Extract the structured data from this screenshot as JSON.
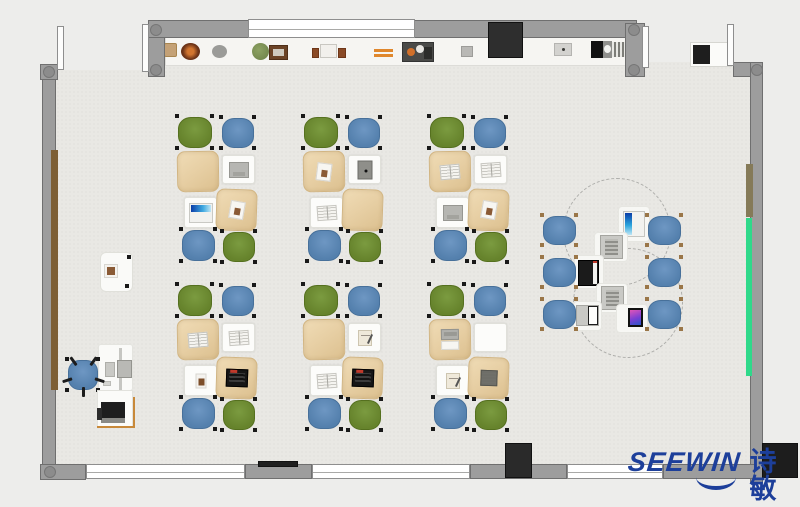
{
  "brand": {
    "name": "SEEWIN",
    "cjk": "诗敏",
    "color": "#1d3f9a"
  },
  "palette": {
    "outside": "#ededeb",
    "floor": "#e9e8e4",
    "wall": "#9d9d9d",
    "wall_border": "#6f6f6f",
    "window": "#ffffff",
    "shelf": "#f6f5f2",
    "desk_white": "#fcfcfa",
    "desk_beige": "#e7cfa4",
    "chair_green": "#66832c",
    "chair_blue": "#5480ad",
    "green_board": "#2fd98a",
    "wood_panel": "#7d5f36",
    "dark_block": "#2e2e2e"
  },
  "floor": {
    "x": 56,
    "y": 38,
    "w": 694,
    "h": 426
  },
  "outside_patches": [
    {
      "name": "outside-patch-top-left",
      "x": 56,
      "y": 38,
      "w": 92,
      "h": 32
    },
    {
      "name": "outside-patch-top-right",
      "x": 645,
      "y": 38,
      "w": 105,
      "h": 24
    }
  ],
  "walls": [
    {
      "name": "wall-left",
      "x": 42,
      "y": 64,
      "w": 14,
      "h": 416
    },
    {
      "name": "wall-corner-top-left",
      "x": 40,
      "y": 64,
      "w": 18,
      "h": 16
    },
    {
      "name": "wall-post-top-left",
      "x": 148,
      "y": 23,
      "w": 17,
      "h": 54
    },
    {
      "name": "wall-top",
      "x": 148,
      "y": 20,
      "w": 489,
      "h": 18
    },
    {
      "name": "wall-post-top-right",
      "x": 625,
      "y": 23,
      "w": 20,
      "h": 54
    },
    {
      "name": "wall-corner-top-right",
      "x": 733,
      "y": 62,
      "w": 30,
      "h": 15
    },
    {
      "name": "wall-right",
      "x": 750,
      "y": 62,
      "w": 13,
      "h": 421
    },
    {
      "name": "wall-corner-bottom-left",
      "x": 40,
      "y": 464,
      "w": 46,
      "h": 16
    },
    {
      "name": "wall-bottom-seg-1",
      "x": 245,
      "y": 464,
      "w": 67,
      "h": 15
    },
    {
      "name": "wall-bottom-seg-2",
      "x": 470,
      "y": 464,
      "w": 97,
      "h": 15
    },
    {
      "name": "wall-bottom-seg-3",
      "x": 663,
      "y": 464,
      "w": 92,
      "h": 15
    }
  ],
  "windows": [
    {
      "name": "window-top",
      "x": 248,
      "y": 19,
      "w": 167,
      "h": 19
    },
    {
      "name": "window-bottom-1",
      "x": 86,
      "y": 464,
      "w": 159,
      "h": 15
    },
    {
      "name": "window-bottom-2",
      "x": 312,
      "y": 464,
      "w": 158,
      "h": 15
    },
    {
      "name": "window-bottom-3",
      "x": 567,
      "y": 464,
      "w": 96,
      "h": 15
    }
  ],
  "columns": [
    {
      "x": 49,
      "y": 72
    },
    {
      "x": 156,
      "y": 30
    },
    {
      "x": 156,
      "y": 70
    },
    {
      "x": 634,
      "y": 30
    },
    {
      "x": 634,
      "y": 70
    },
    {
      "x": 757,
      "y": 70
    },
    {
      "x": 50,
      "y": 472
    }
  ],
  "door_leaves": [
    {
      "name": "door-leaf-top-left-a",
      "x": 57,
      "y": 26,
      "w": 7,
      "h": 44
    },
    {
      "name": "door-leaf-top-left-b",
      "x": 142,
      "y": 24,
      "w": 7,
      "h": 48
    },
    {
      "name": "door-leaf-top-right-a",
      "x": 642,
      "y": 26,
      "w": 7,
      "h": 42
    },
    {
      "name": "door-leaf-top-right-b",
      "x": 727,
      "y": 24,
      "w": 7,
      "h": 42
    }
  ],
  "wall_strips": [
    {
      "name": "wood-panel-left-wall",
      "x": 51,
      "y": 150,
      "w": 7,
      "h": 240,
      "c": "#7d5f36"
    },
    {
      "name": "wood-panel-right-wall",
      "x": 746,
      "y": 164,
      "w": 7,
      "h": 53,
      "c": "#857a58"
    },
    {
      "name": "green-board-right-wall",
      "x": 746,
      "y": 218,
      "w": 6,
      "h": 158,
      "c": "#2fd98a"
    }
  ],
  "blocks": [
    {
      "name": "dark-cabinet-top-wall",
      "x": 488,
      "y": 22,
      "w": 35,
      "h": 36,
      "c": "#2e2e2e"
    },
    {
      "name": "dark-cabinet-bottom-wall",
      "x": 505,
      "y": 443,
      "w": 27,
      "h": 35,
      "c": "#2a2a2a"
    },
    {
      "name": "dark-column-bottom-right",
      "x": 762,
      "y": 443,
      "w": 36,
      "h": 35,
      "c": "#1d1d1d"
    },
    {
      "name": "dark-bar-bottom-wall",
      "x": 258,
      "y": 461,
      "w": 40,
      "h": 6,
      "c": "#1f1f1f"
    }
  ],
  "shelf": {
    "x": 165,
    "y": 38,
    "w": 462,
    "h": 28,
    "items": [
      {
        "type": "box-tan",
        "x": 164,
        "y": 43,
        "w": 13,
        "h": 14
      },
      {
        "type": "donut",
        "x": 181,
        "y": 43,
        "w": 19,
        "h": 17
      },
      {
        "type": "circle-gray",
        "x": 212,
        "y": 45,
        "w": 15,
        "h": 13
      },
      {
        "type": "plant",
        "x": 252,
        "y": 43,
        "w": 17,
        "h": 17
      },
      {
        "type": "frame",
        "x": 269,
        "y": 45,
        "w": 19,
        "h": 15
      },
      {
        "type": "book-brown",
        "x": 312,
        "y": 48,
        "w": 7,
        "h": 10
      },
      {
        "type": "box-white",
        "x": 320,
        "y": 44,
        "w": 17,
        "h": 14
      },
      {
        "type": "book-brown",
        "x": 338,
        "y": 48,
        "w": 8,
        "h": 10
      },
      {
        "type": "sticks",
        "x": 374,
        "y": 49,
        "w": 19,
        "h": 8
      },
      {
        "type": "tray",
        "x": 402,
        "y": 42,
        "w": 32,
        "h": 20
      },
      {
        "type": "box-small",
        "x": 461,
        "y": 46,
        "w": 12,
        "h": 11
      },
      {
        "type": "box-dot",
        "x": 554,
        "y": 43,
        "w": 18,
        "h": 13
      },
      {
        "type": "device-bw",
        "x": 591,
        "y": 41,
        "w": 34,
        "h": 17
      }
    ]
  },
  "doorway_shelf": {
    "x": 690,
    "y": 42,
    "w": 42,
    "h": 25,
    "item": [
      693,
      45,
      17,
      19
    ]
  },
  "clusters": {
    "origins": [
      [
        177,
        116
      ],
      [
        303,
        116
      ],
      [
        429,
        116
      ],
      [
        177,
        284
      ],
      [
        303,
        284
      ],
      [
        429,
        284
      ]
    ],
    "chairs": [
      {
        "color": "green",
        "x": 1,
        "y": 1,
        "w": 34,
        "h": 31
      },
      {
        "color": "blue",
        "x": 45,
        "y": 2,
        "w": 32,
        "h": 30
      },
      {
        "color": "blue",
        "x": 5,
        "y": 114,
        "w": 33,
        "h": 31
      },
      {
        "color": "green",
        "x": 46,
        "y": 116,
        "w": 32,
        "h": 30
      }
    ],
    "desks": [
      {
        "kind": "beige",
        "pos": "tl",
        "x": 0,
        "y": 35,
        "w": 42,
        "h": 41,
        "rot": -1
      },
      {
        "kind": "white",
        "pos": "tr",
        "x": 45,
        "y": 39,
        "w": 33,
        "h": 29,
        "rot": 0
      },
      {
        "kind": "white",
        "pos": "bl",
        "x": 7,
        "y": 81,
        "w": 33,
        "h": 31,
        "rot": 0
      },
      {
        "kind": "beige",
        "pos": "br",
        "x": 39,
        "y": 73,
        "w": 41,
        "h": 42,
        "rot": 2
      }
    ],
    "desk_items": [
      {
        "tl": "none",
        "tr": "laptop-gray",
        "bl": "laptop-blue",
        "br": "paper"
      },
      {
        "tl": "paper",
        "tr": "tablet-dark",
        "bl": "book-open",
        "br": "none"
      },
      {
        "tl": "book-open",
        "tr": "book-open",
        "bl": "laptop-gray",
        "br": "paper"
      },
      {
        "tl": "book-open",
        "tr": "book-open",
        "bl": "photo-brown",
        "br": "laptop-black"
      },
      {
        "tl": "none",
        "tr": "notebook",
        "bl": "book-open",
        "br": "laptop-black"
      },
      {
        "tl": "laptop-sheet",
        "tr": "none",
        "bl": "notebook",
        "br": "book-dark"
      }
    ]
  },
  "pod": {
    "circles": [
      {
        "cx": 617,
        "cy": 232,
        "r": 54
      },
      {
        "cx": 628,
        "cy": 303,
        "r": 55
      }
    ],
    "chairs": [
      [
        543,
        216
      ],
      [
        543,
        258
      ],
      [
        543,
        300
      ],
      [
        648,
        216
      ],
      [
        648,
        258
      ],
      [
        648,
        300
      ]
    ],
    "chair_size": [
      33,
      29
    ],
    "devices": [
      {
        "type": "tablet-blue",
        "tile": [
          618,
          206,
          32,
          36
        ],
        "dev": [
          623,
          211,
          22,
          26
        ]
      },
      {
        "type": "tablet-gray",
        "tile": [
          594,
          232,
          34,
          30
        ],
        "dev": [
          600,
          235,
          23,
          24
        ]
      },
      {
        "type": "laptop-black-pod",
        "tile": [
          574,
          255,
          30,
          34
        ],
        "dev": [
          578,
          260,
          21,
          26
        ]
      },
      {
        "type": "tablet-gray",
        "tile": [
          596,
          283,
          32,
          30
        ],
        "dev": [
          601,
          286,
          23,
          24
        ]
      },
      {
        "type": "laptop-white",
        "tile": [
          573,
          301,
          29,
          30
        ],
        "dev": [
          576,
          305,
          23,
          21
        ]
      },
      {
        "type": "phone",
        "tile": [
          616,
          304,
          32,
          29
        ],
        "dev": [
          628,
          308,
          15,
          19
        ]
      }
    ]
  },
  "teacher": {
    "cabinet": {
      "x": 100,
      "y": 252,
      "w": 33,
      "h": 40,
      "photo": [
        104,
        264,
        14,
        14
      ]
    },
    "chair": {
      "x": 68,
      "y": 360,
      "w": 30,
      "h": 30
    },
    "desk": {
      "x": 98,
      "y": 344,
      "w": 35,
      "h": 47,
      "stand": [
        119,
        348,
        3,
        42
      ],
      "keyboard": [
        105,
        362,
        10,
        15
      ],
      "monitor": [
        117,
        360,
        15,
        18
      ],
      "mouse": [
        103,
        381,
        8,
        5
      ]
    },
    "printer_stand": {
      "x": 97,
      "y": 390,
      "w": 36,
      "h": 38
    },
    "printer": {
      "x": 101,
      "y": 402,
      "w": 24,
      "h": 21
    },
    "edge_lines": {
      "v": [
        133,
        397,
        2,
        31
      ],
      "h": [
        97,
        426,
        38,
        2
      ],
      "c": "#c8893a"
    }
  },
  "logo": {
    "x": 628,
    "y": 449
  }
}
